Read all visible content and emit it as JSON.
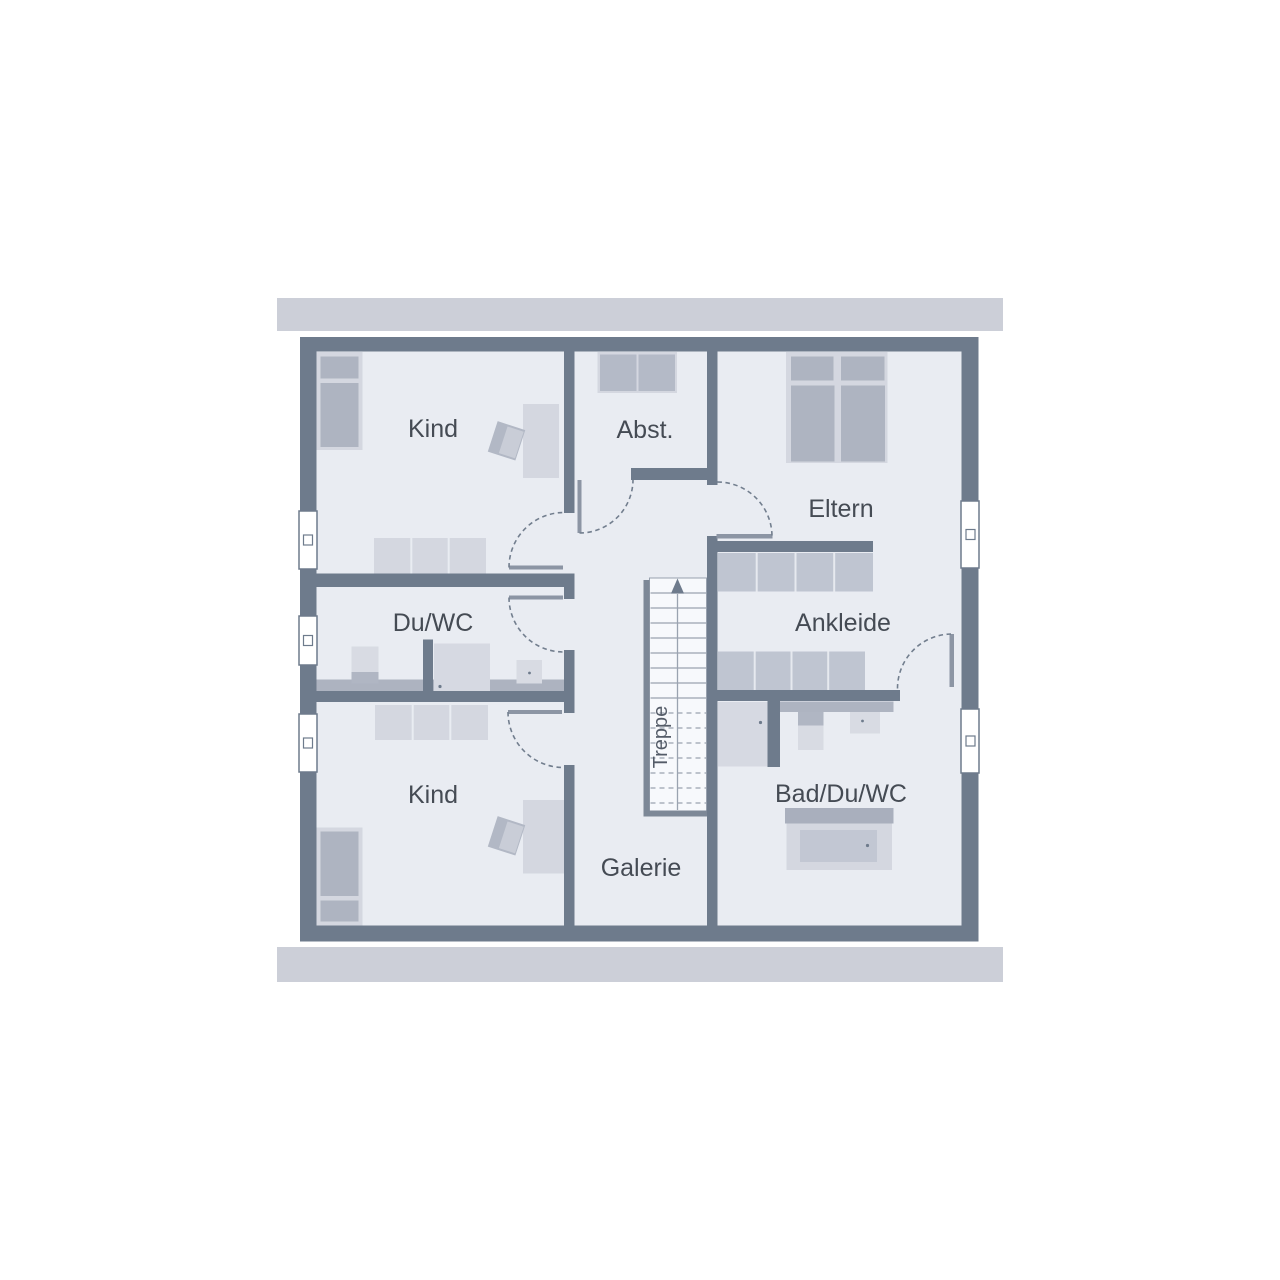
{
  "floorplan": {
    "title": "attic floor plan",
    "rooms": {
      "kind_top": {
        "label": "Kind"
      },
      "abstellraum": {
        "label": "Abst."
      },
      "eltern": {
        "label": "Eltern"
      },
      "du_wc": {
        "label": "Du/WC"
      },
      "ankleide": {
        "label": "Ankleide"
      },
      "kind_bottom": {
        "label": "Kind"
      },
      "bad_du_wc": {
        "label": "Bad/Du/WC"
      },
      "galerie": {
        "label": "Galerie"
      },
      "treppe": {
        "label": "Treppe"
      }
    },
    "colors": {
      "wall": "#6e7b8c",
      "floor": "#e9ecf2",
      "eave_bar": "#cccfd8",
      "furniture_light": "#d4d7e0",
      "furniture_medium": "#aeb4c1",
      "wardrobe": "#bfc5d1",
      "stairwell": "#f7f9fc",
      "railing": "#7d8897",
      "door_leaf": "#8c95a4",
      "label_text": "#454b54"
    }
  }
}
